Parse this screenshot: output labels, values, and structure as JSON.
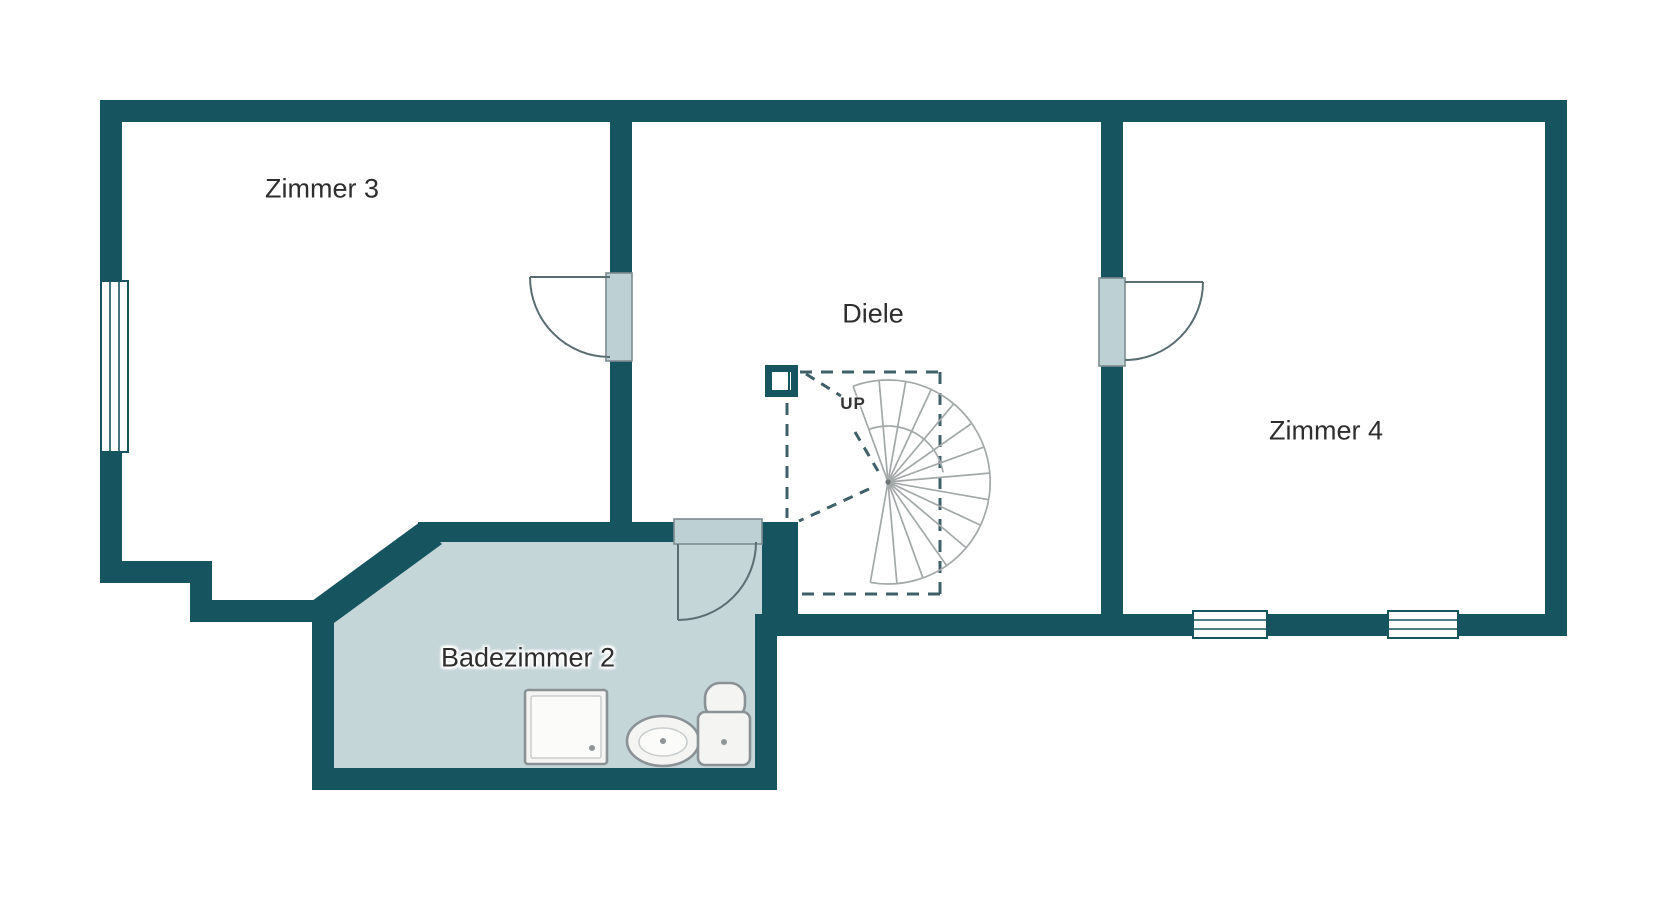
{
  "plan": {
    "type": "floor-plan",
    "floor_label_language": "de"
  },
  "colors": {
    "wall": "#16545f",
    "bathroom_floor": "#c5d6d9",
    "door_leaf": "#bdd0d4",
    "dash": "#3f6069",
    "stair_line": "#a3a8a8",
    "label_text": "#2e2e2e"
  },
  "rooms": {
    "zimmer3": {
      "label": "Zimmer 3"
    },
    "diele": {
      "label": "Diele"
    },
    "zimmer4": {
      "label": "Zimmer 4"
    },
    "badezimmer2": {
      "label": "Badezimmer 2"
    }
  },
  "stairs": {
    "direction_label": "UP",
    "type": "spiral"
  },
  "icons": {
    "shower": "shower-tray",
    "sink": "washbasin-oval",
    "toilet": "wc-with-cistern",
    "window": "triple-line-window",
    "door": "quarter-swing-door"
  }
}
